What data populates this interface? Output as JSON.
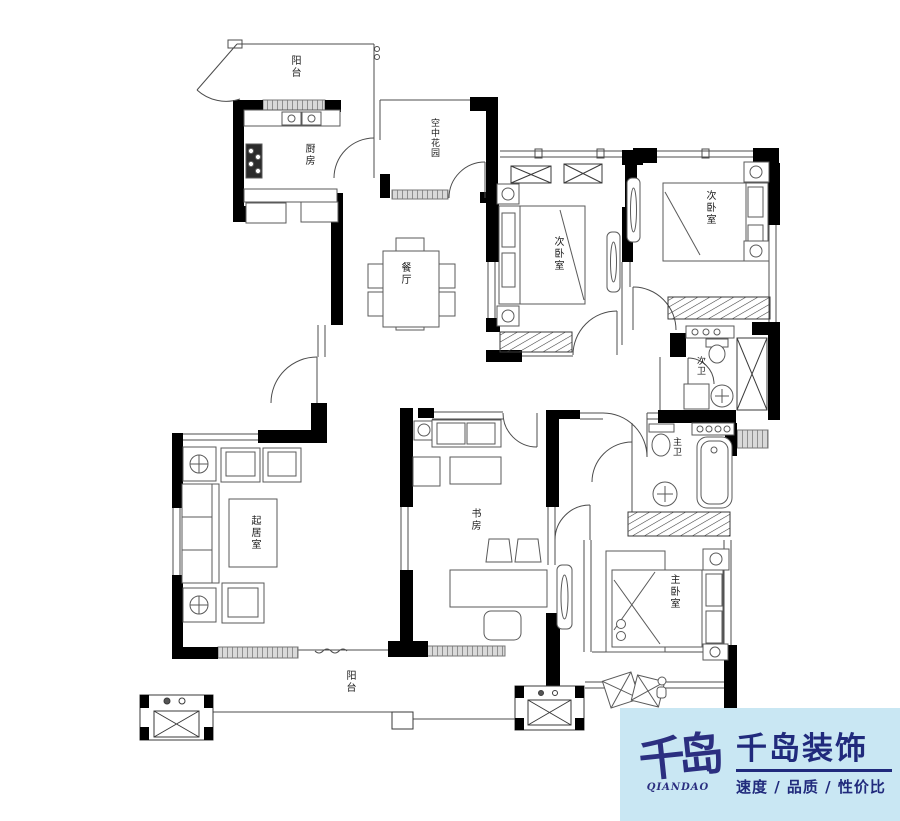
{
  "page": {
    "background": "#ffffff"
  },
  "floorplan": {
    "rooms": [
      {
        "id": "balcony-top",
        "label": "阳台"
      },
      {
        "id": "kitchen",
        "label": "厨房"
      },
      {
        "id": "sky-garden",
        "label": "空中花园"
      },
      {
        "id": "bedroom-second-left",
        "label": "次卧室"
      },
      {
        "id": "bedroom-second-right",
        "label": "次卧室"
      },
      {
        "id": "dining",
        "label": "餐厅"
      },
      {
        "id": "bath-second",
        "label": "次卫"
      },
      {
        "id": "bath-master",
        "label": "主卫"
      },
      {
        "id": "living",
        "label": "起居室"
      },
      {
        "id": "study",
        "label": "书房"
      },
      {
        "id": "bedroom-master",
        "label": "主卧室"
      },
      {
        "id": "balcony-bottom",
        "label": "阳台"
      }
    ],
    "colors": {
      "wall": "#000000",
      "line": "#4c4c4c",
      "window_fill": "#d9d9d9"
    }
  },
  "logo": {
    "mark": "千岛",
    "mark_caption": "QIANDAO",
    "company": "千岛装饰",
    "tagline": "速度 / 品质 / 性价比",
    "bg": "#c9e7f3",
    "color": "#202a7c"
  }
}
